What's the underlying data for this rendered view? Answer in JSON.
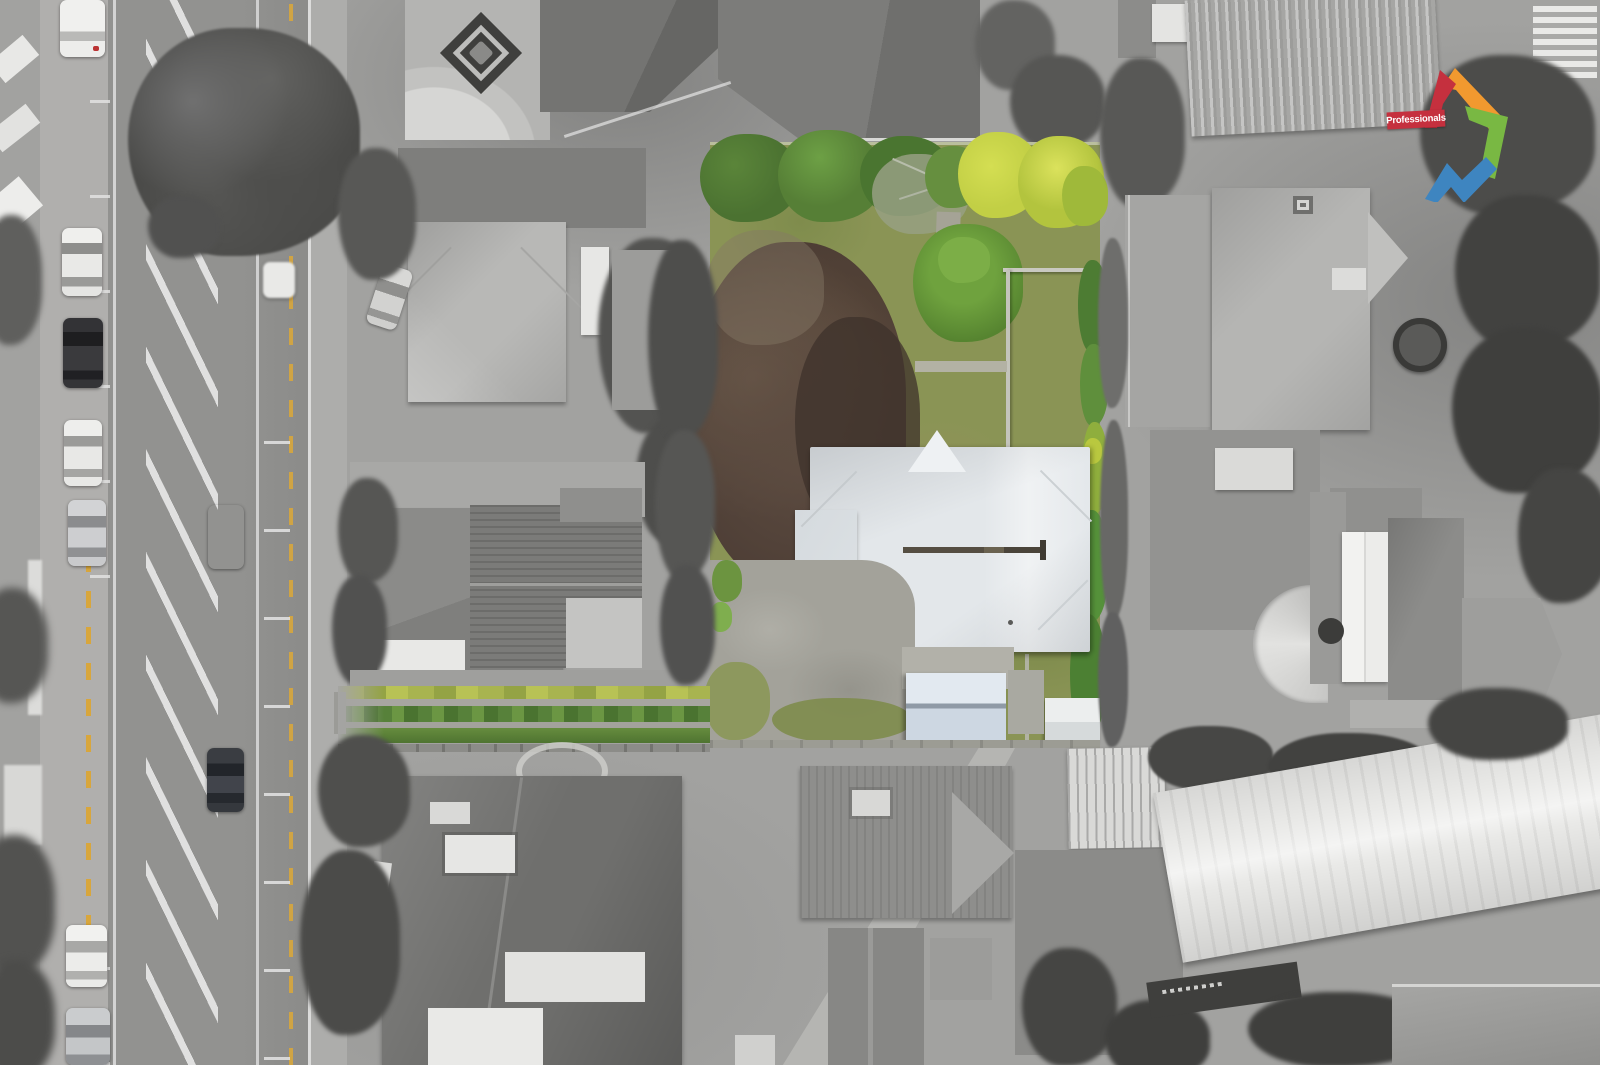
{
  "scene": {
    "type": "aerial-drone-photograph",
    "treatment": "grayscale surroundings with one property lot highlighted in colour",
    "street": "vertical two-way street with flush hatched median, kerbside parking bays, yellow no-stopping dashes",
    "highlighted_property": "rear lot: green lawns, tree-lined boundary, large copper beech tree, white hip-roof villa, gravel driveway, blue-grey shed roof",
    "access_strip": "long hedge-lined driveway strip connecting lot to street, also in colour",
    "vehicles": "parked cars on kerb, one orange car and one dark car driving"
  },
  "logo": {
    "brand": "Professionals"
  },
  "colors": {
    "logo-red": "#c5303e",
    "logo-orange": "#f1992f",
    "logo-green": "#79b843",
    "logo-blue": "#3e85c0",
    "banner-red": "#c5303e",
    "lawn": "#8a9455",
    "hedge": "#57823a",
    "shrub-yellow": "#c2cf45",
    "copper-tree": "#4a3b33",
    "roof-white": "#e3e7ea",
    "shed-roof": "#cdd7e2",
    "gravel": "#a3a29a",
    "road": "#8e8e8e",
    "mark-white": "#e4e4e4",
    "mark-yellow": "#d8a63c",
    "car-orange": "#e2852f"
  }
}
